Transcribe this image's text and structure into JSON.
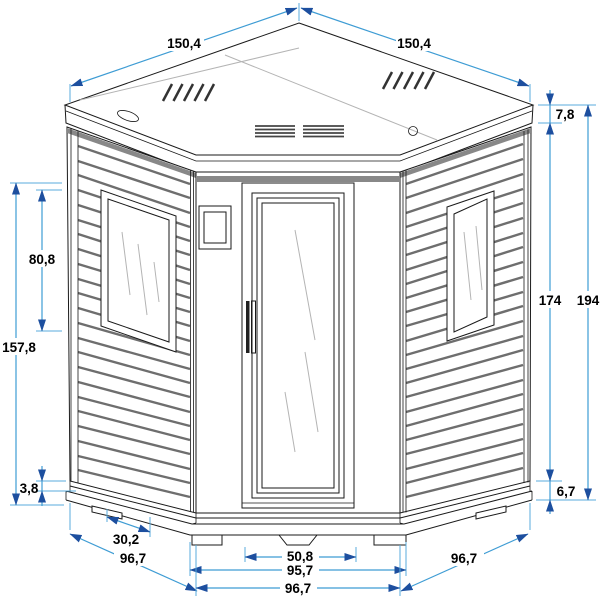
{
  "drawing": {
    "subject": "corner sauna cabin - dimensioned technical drawing, isometric front view",
    "colors": {
      "background": "#ffffff",
      "outline": "#1a1a1a",
      "siding_shadow": "#6e6e6e",
      "dimension_line": "#3E9CD4",
      "dimension_arrow": "#1D4F9F",
      "label_text": "#000000"
    },
    "features": {
      "roof_vent_left": "slanted-vent-grille",
      "roof_vent_right": "slanted-vent-grille",
      "roof_vents_front": "horizontal-vent-slots",
      "roof_hole": "round-hole",
      "roof_slot": "oval-slot",
      "door": "glass-door",
      "door_handle": "vertical-pull-handle",
      "control_box": "wall-mounted-box",
      "left_window": "vertical-window",
      "right_window": "vertical-window"
    },
    "dims": {
      "roof_left": "150,4",
      "roof_right": "150,4",
      "roof_edge": "7,8",
      "wall_height": "174",
      "total_height": "194",
      "base_height": "6,7",
      "window_height": "80,8",
      "siding_height": "157,8",
      "base_trim": "3,8",
      "foot_offset": "30,2",
      "left_wall_width": "96,7",
      "door_base_width": "50,8",
      "front_base_width": "95,7",
      "front_wall_width": "96,7",
      "right_wall_width": "96,7"
    }
  }
}
